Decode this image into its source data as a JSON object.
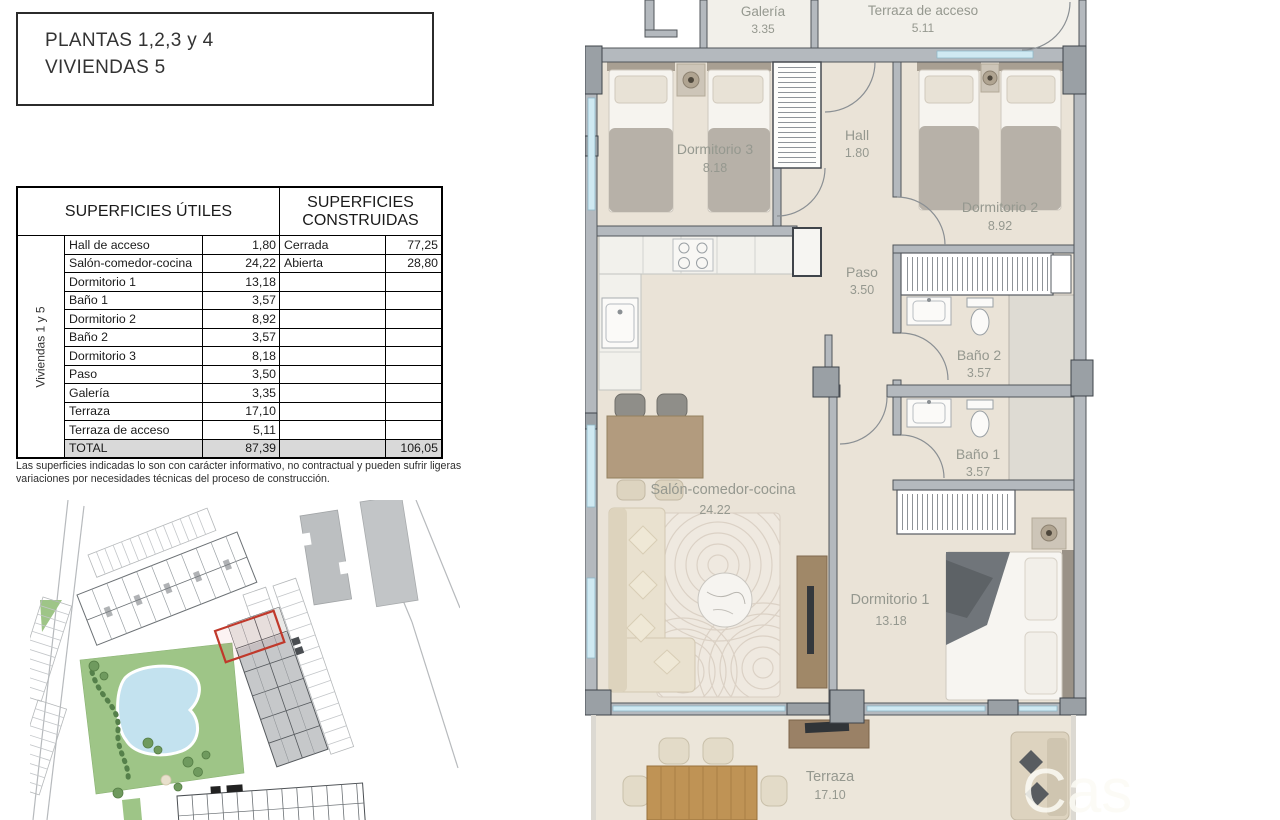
{
  "title_box": {
    "line1": "PLANTAS 1,2,3 y 4",
    "line2": "VIVIENDAS 5"
  },
  "surfaces_table": {
    "header_left": "SUPERFICIES ÚTILES",
    "header_right": "SUPERFICIES CONSTRUIDAS",
    "side_label": "Viviendas 1 y 5",
    "rows": [
      {
        "name": "Hall de acceso",
        "value": "1,80",
        "name2": "Cerrada",
        "value2": "77,25"
      },
      {
        "name": "Salón-comedor-cocina",
        "value": "24,22",
        "name2": "Abierta",
        "value2": "28,80"
      },
      {
        "name": "Dormitorio 1",
        "value": "13,18",
        "name2": "",
        "value2": ""
      },
      {
        "name": "Baño 1",
        "value": "3,57",
        "name2": "",
        "value2": ""
      },
      {
        "name": "Dormitorio 2",
        "value": "8,92",
        "name2": "",
        "value2": ""
      },
      {
        "name": "Baño 2",
        "value": "3,57",
        "name2": "",
        "value2": ""
      },
      {
        "name": "Dormitorio 3",
        "value": "8,18",
        "name2": "",
        "value2": ""
      },
      {
        "name": "Paso",
        "value": "3,50",
        "name2": "",
        "value2": ""
      },
      {
        "name": "Galería",
        "value": "3,35",
        "name2": "",
        "value2": ""
      },
      {
        "name": "Terraza",
        "value": "17,10",
        "name2": "",
        "value2": ""
      },
      {
        "name": "Terraza de acceso",
        "value": "5,11",
        "name2": "",
        "value2": ""
      }
    ],
    "total_row": {
      "name": "TOTAL",
      "value": "87,39",
      "name2": "",
      "value2": "106,05"
    }
  },
  "note": "Las superficies indicadas lo son con carácter informativo, no contractual y pueden sufrir ligeras variaciones por necesidades técnicas del proceso de construcción.",
  "floor_plan": {
    "rooms": [
      {
        "name": "Galería",
        "area": "3.35"
      },
      {
        "name": "Terraza de acceso",
        "area": "5.11"
      },
      {
        "name": "Dormitorio 3",
        "area": "8.18"
      },
      {
        "name": "Hall",
        "area": "1.80"
      },
      {
        "name": "Dormitorio 2",
        "area": "8.92"
      },
      {
        "name": "Paso",
        "area": "3.50"
      },
      {
        "name": "Baño 2",
        "area": "3.57"
      },
      {
        "name": "Baño 1",
        "area": "3.57"
      },
      {
        "name": "Salón-comedor-cocina",
        "area": "24.22"
      },
      {
        "name": "Dormitorio 1",
        "area": "13.18"
      },
      {
        "name": "Terraza",
        "area": "17.10"
      }
    ],
    "watermark": "Cas"
  },
  "colors": {
    "wall": "#b4b9be",
    "floor": "#eae3d7",
    "accent_red": "#c0392b",
    "glass": "#cfe9f2",
    "site_green": "#9ec587",
    "pool": "#c3e2ef"
  }
}
